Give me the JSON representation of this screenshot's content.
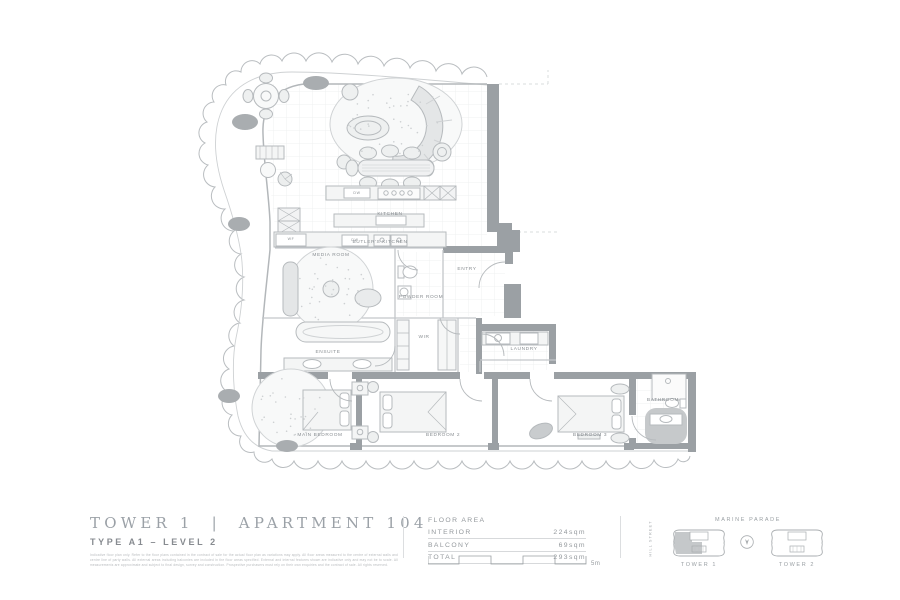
{
  "header": {
    "title": "TOWER 1  |  APARTMENT 104",
    "subtitle": "TYPE A1 – LEVEL 2",
    "disclaimer": "Indicative floor plan only. Refer to the floor plans contained in the contract of sale for the actual floor plan as variations may apply. All floor areas measured to the centre of external walls and centre line of party walls. All external areas including balconies are included in the floor areas specified. External and internal features shown are indicative only and may not be to scale. All measurements are approximate and subject to final design, survey and construction. Prospective purchasers must rely on their own enquiries and the contract of sale. All rights reserved."
  },
  "area_table": {
    "title": "FLOOR AREA",
    "rows": [
      {
        "label": "INTERIOR",
        "value": "224sqm"
      },
      {
        "label": "BALCONY",
        "value": "69sqm"
      },
      {
        "label": "TOTAL",
        "value": "293sqm"
      }
    ]
  },
  "scale_bar": {
    "label": "5m"
  },
  "locator": {
    "street_top": "MARINE PARADE",
    "street_side": "HILL STREET",
    "tower1_label": "TOWER 1",
    "tower2_label": "TOWER 2"
  },
  "plan": {
    "room_labels": [
      {
        "text": "KITCHEN",
        "x": 390,
        "y": 215
      },
      {
        "text": "BUTLER'S KITCHEN",
        "x": 380,
        "y": 243
      },
      {
        "text": "MEDIA ROOM",
        "x": 331,
        "y": 256
      },
      {
        "text": "POWDER ROOM",
        "x": 421,
        "y": 298
      },
      {
        "text": "ENTRY",
        "x": 467,
        "y": 270
      },
      {
        "text": "WIR",
        "x": 424,
        "y": 338
      },
      {
        "text": "ENSUITE",
        "x": 328,
        "y": 353
      },
      {
        "text": "LAUNDRY",
        "x": 524,
        "y": 350
      },
      {
        "text": "MAIN BEDROOM",
        "x": 320,
        "y": 436
      },
      {
        "text": "BEDROOM 2",
        "x": 443,
        "y": 436
      },
      {
        "text": "BEDROOM 3",
        "x": 590,
        "y": 436
      },
      {
        "text": "BATHROOM",
        "x": 663,
        "y": 401
      }
    ],
    "small_labels": [
      {
        "text": "WF",
        "x": 291,
        "y": 240
      },
      {
        "text": "DW",
        "x": 357,
        "y": 194
      },
      {
        "text": "DW",
        "x": 355,
        "y": 241
      }
    ],
    "colors": {
      "wall": "#9ba0a4",
      "line": "#b6babd",
      "accent_gray": "#a9adb0"
    }
  }
}
